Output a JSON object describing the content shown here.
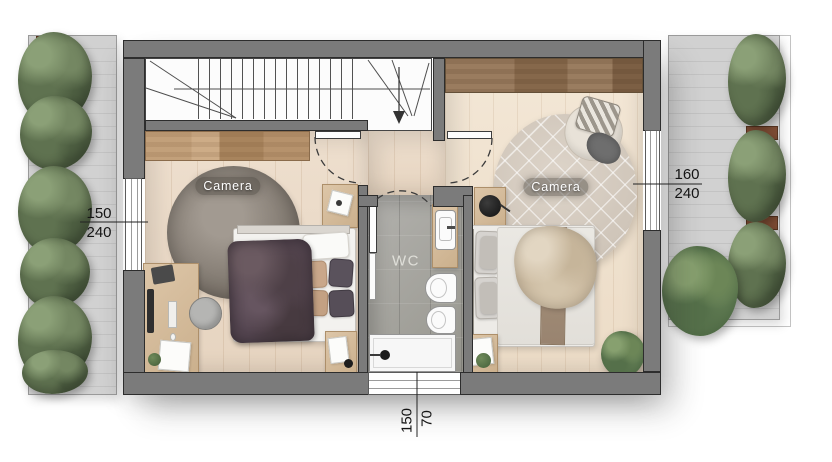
{
  "title": "Apartment upper floor plan",
  "labels": {
    "bedroom_left": "Camera",
    "bedroom_right": "Camera",
    "wc": "WC"
  },
  "dimensions": {
    "left_window": {
      "width_cm": "150",
      "height_cm": "240"
    },
    "right_window": {
      "width_cm": "160",
      "height_cm": "240"
    },
    "bottom_window": {
      "width_cm": "150",
      "height_cm": "70"
    }
  },
  "icons": {
    "stair_direction": "arrow-down"
  },
  "colors": {
    "wall": "#7b7b7b",
    "wall_outline": "#2d2d2d",
    "wood_floor_left": "#ecdcca",
    "wood_floor_right": "#f1e5d4",
    "wc_tile": "#a6a5a1",
    "terrace_concrete": "#cccccc",
    "foliage": "#66785a",
    "rug_left": "#84796e",
    "rug_right": "#d9d0c5",
    "dimension_text": "#141414",
    "room_label_text": "#ffffff"
  }
}
